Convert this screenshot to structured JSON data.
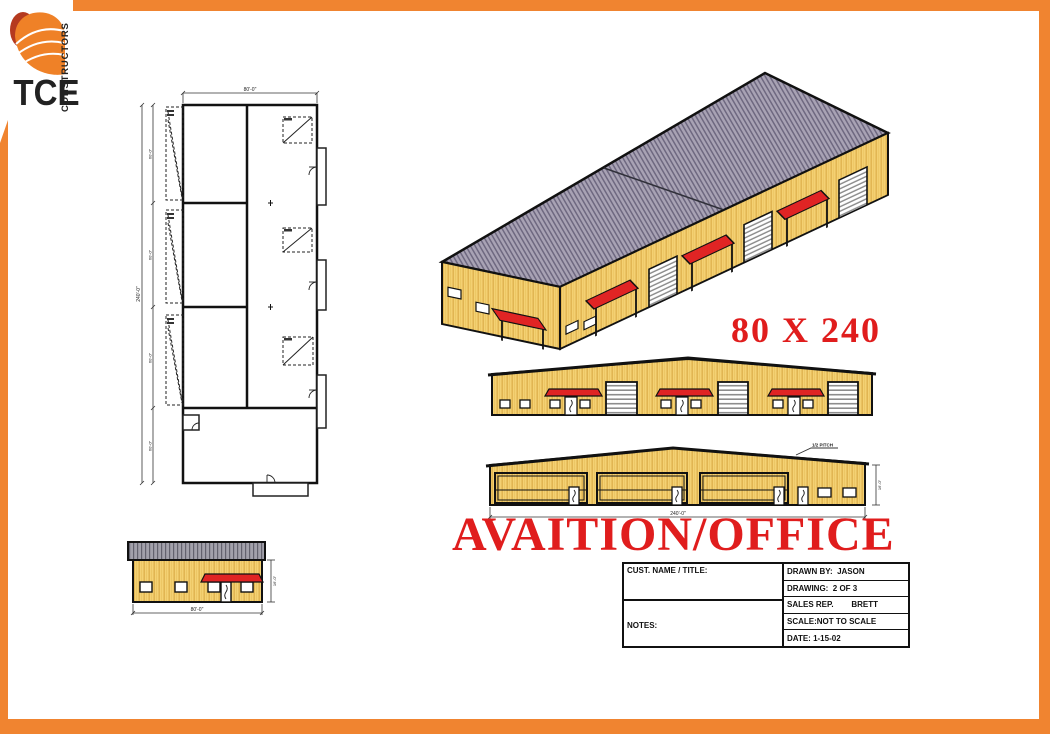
{
  "colors": {
    "frame_orange": "#f08430",
    "annotation_red": "#e01d1d",
    "wall_yellow": "#f4d173",
    "roof_gray": "#a8a2b4",
    "logo_navy": "#1b3a6e",
    "logo_blue": "#2b62a8"
  },
  "logo": {
    "name": "TCE",
    "subtitle": "CONSTRUCTORS"
  },
  "labels": {
    "size": "80 X 240",
    "title": "AVAITION/OFFICE"
  },
  "drawings": {
    "floor_plan": {
      "dim_width": "80'-0\"",
      "dim_length": "240'-0\"",
      "dim_bay": "60'-0\""
    },
    "awning_elevation": {},
    "hangar_elevation": {
      "dim_length": "240'-0\"",
      "dim_height": "16'-0\"",
      "pitch_note": "1/2 PITCH"
    },
    "end_elevation": {
      "dim_width": "80'-0\"",
      "dim_height": "16'-0\""
    }
  },
  "title_block": {
    "cust_label": "CUST. NAME / TITLE:",
    "notes_label": "NOTES:",
    "notes_lines": [
      "CONCEPTUAL ARCHITECTURAL",
      "DRAWING.  PLEASE VERIFY",
      "EXACT ENGINEERING"
    ],
    "drawn_by": "DRAWN BY:  JASON",
    "drawing_no": "DRAWING:  2 OF 3",
    "sales_rep": "SALES REP.        BRETT",
    "scale": "SCALE:NOT TO SCALE",
    "date": "DATE: 1-15-02"
  }
}
